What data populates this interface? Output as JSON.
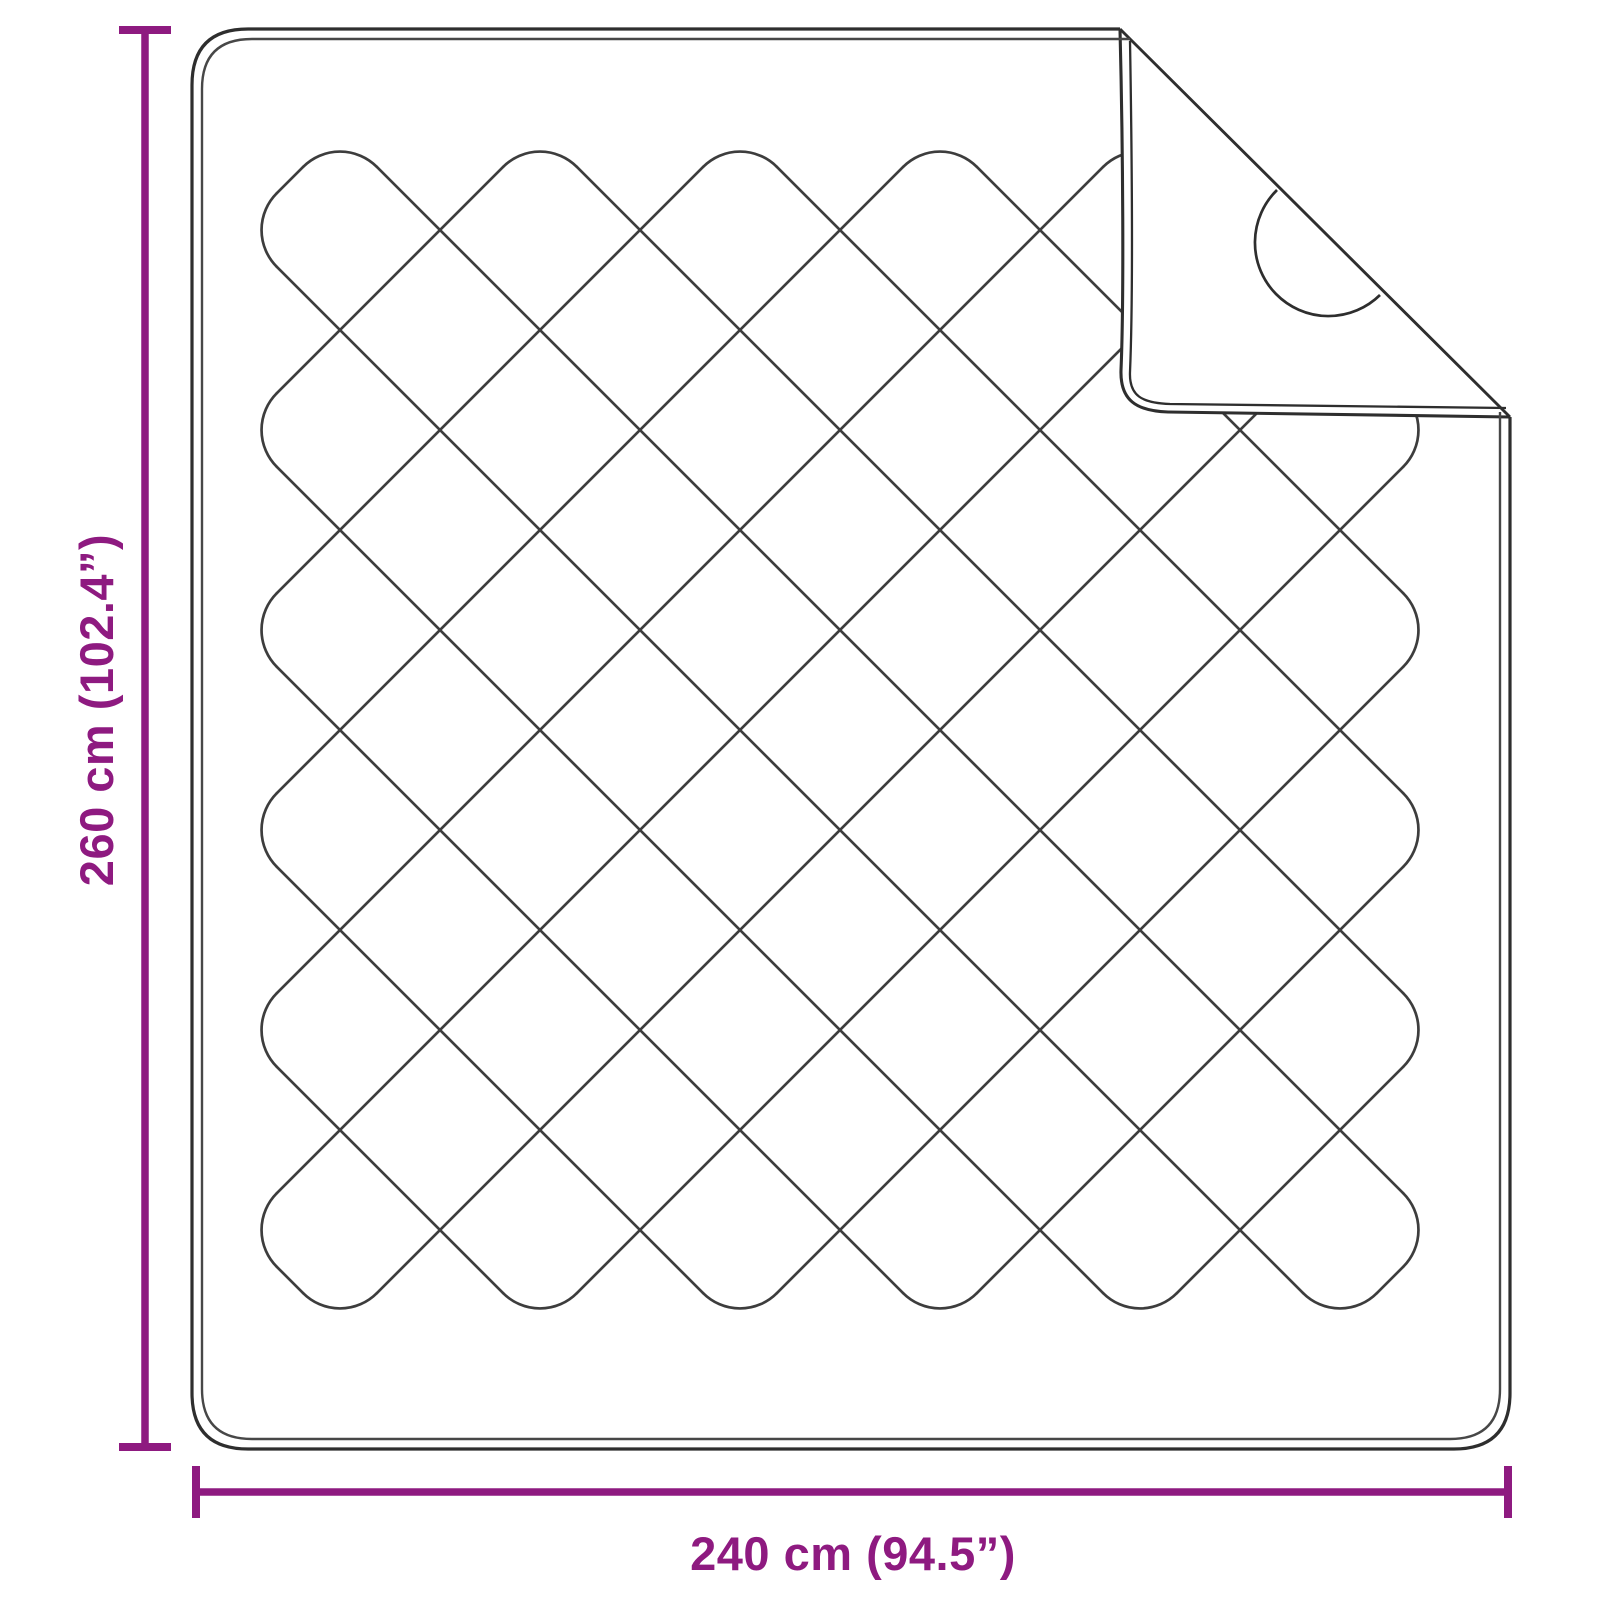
{
  "diagram": {
    "title": "blanket-dimension-diagram",
    "height_label": "260 cm (102.4”)",
    "width_label": "240 cm (94.5”)"
  },
  "colors": {
    "dimension": "#8e1a80",
    "stitch": "#3d3d3d",
    "outline": "#2e2e2e",
    "outline_light": "#474747",
    "background": "#ffffff"
  }
}
